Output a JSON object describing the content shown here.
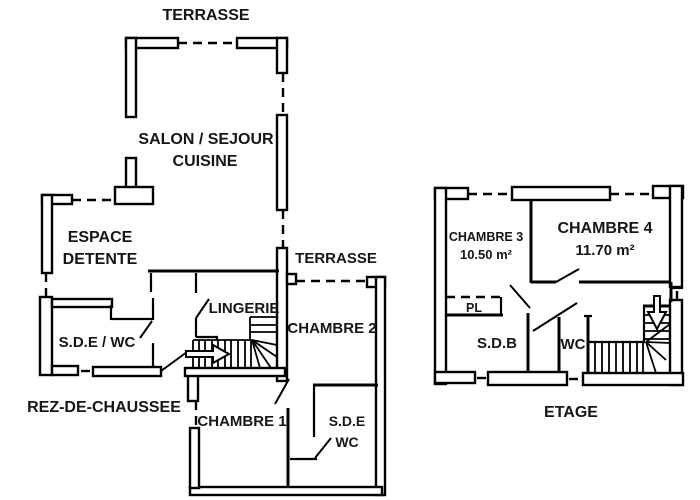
{
  "plans": {
    "rdc": {
      "title": "REZ-DE-CHAUSSEE",
      "rooms": {
        "terrace_top": "TERRASSE",
        "salon_line1": "SALON / SEJOUR",
        "salon_line2": "CUISINE",
        "espace_line1": "ESPACE",
        "espace_line2": "DETENTE",
        "sde_wc": "S.D.E / WC",
        "lingerie": "LINGERIE",
        "terrace_right": "TERRASSE",
        "chambre2": "CHAMBRE 2",
        "chambre1": "CHAMBRE 1",
        "sde2_line1": "S.D.E",
        "sde2_line2": "WC"
      }
    },
    "etage": {
      "title": "ETAGE",
      "rooms": {
        "chambre3": "CHAMBRE 3",
        "chambre3_area": "10.50 m²",
        "chambre4": "CHAMBRE 4",
        "chambre4_area": "11.70 m²",
        "pl": "PL",
        "sdb": "S.D.B",
        "wc": "WC"
      }
    }
  },
  "colors": {
    "wall": "#000000",
    "background": "#ffffff"
  }
}
